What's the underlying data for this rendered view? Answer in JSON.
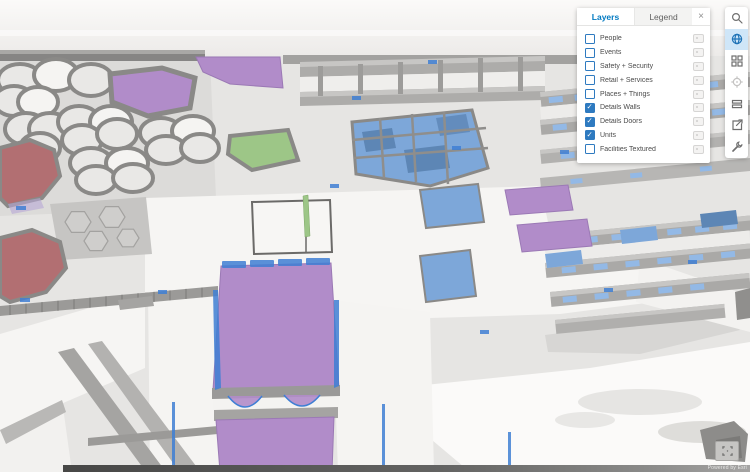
{
  "ui": {
    "accent": "#0079c1",
    "checkbox": "#2e7ac0",
    "toolbar_active": "#cfe6f8"
  },
  "panel": {
    "tabs": [
      {
        "label": "Layers",
        "active": true
      },
      {
        "label": "Legend",
        "active": false
      }
    ],
    "close_label": "×",
    "layers": [
      {
        "label": "People",
        "checked": false
      },
      {
        "label": "Events",
        "checked": false
      },
      {
        "label": "Safety + Security",
        "checked": false
      },
      {
        "label": "Retail + Services",
        "checked": false
      },
      {
        "label": "Places + Things",
        "checked": false
      },
      {
        "label": "Details Walls",
        "checked": true
      },
      {
        "label": "Details Doors",
        "checked": true
      },
      {
        "label": "Units",
        "checked": true
      },
      {
        "label": "Facilities Textured",
        "checked": false
      }
    ],
    "check_glyph": "✓"
  },
  "toolbar": {
    "items": [
      {
        "icon": "search",
        "active": false
      },
      {
        "icon": "globe",
        "active": true
      },
      {
        "icon": "basemap",
        "active": false
      },
      {
        "icon": "locate",
        "active": false
      },
      {
        "icon": "levels",
        "active": false
      },
      {
        "icon": "share",
        "active": false
      },
      {
        "icon": "tools",
        "active": false
      }
    ]
  },
  "map": {
    "attribution": "Powered by Esri",
    "colors": {
      "purple": "#b18cc9",
      "purple_edge": "#9b79b5",
      "green": "#9dc687",
      "red": "#b26f72",
      "blue_room": "#7da7d9",
      "blue_dark": "#5d86b5",
      "door_blue": "#3f7fd4",
      "glass": "#93b9e6",
      "wall": "#9a9998",
      "wall_top": "#c7c6c4",
      "wall_dark": "#6f6e6c",
      "floor_white": "#f6f5f3",
      "ground": "#e6e5e3",
      "sky": "#fbfaf9"
    }
  }
}
